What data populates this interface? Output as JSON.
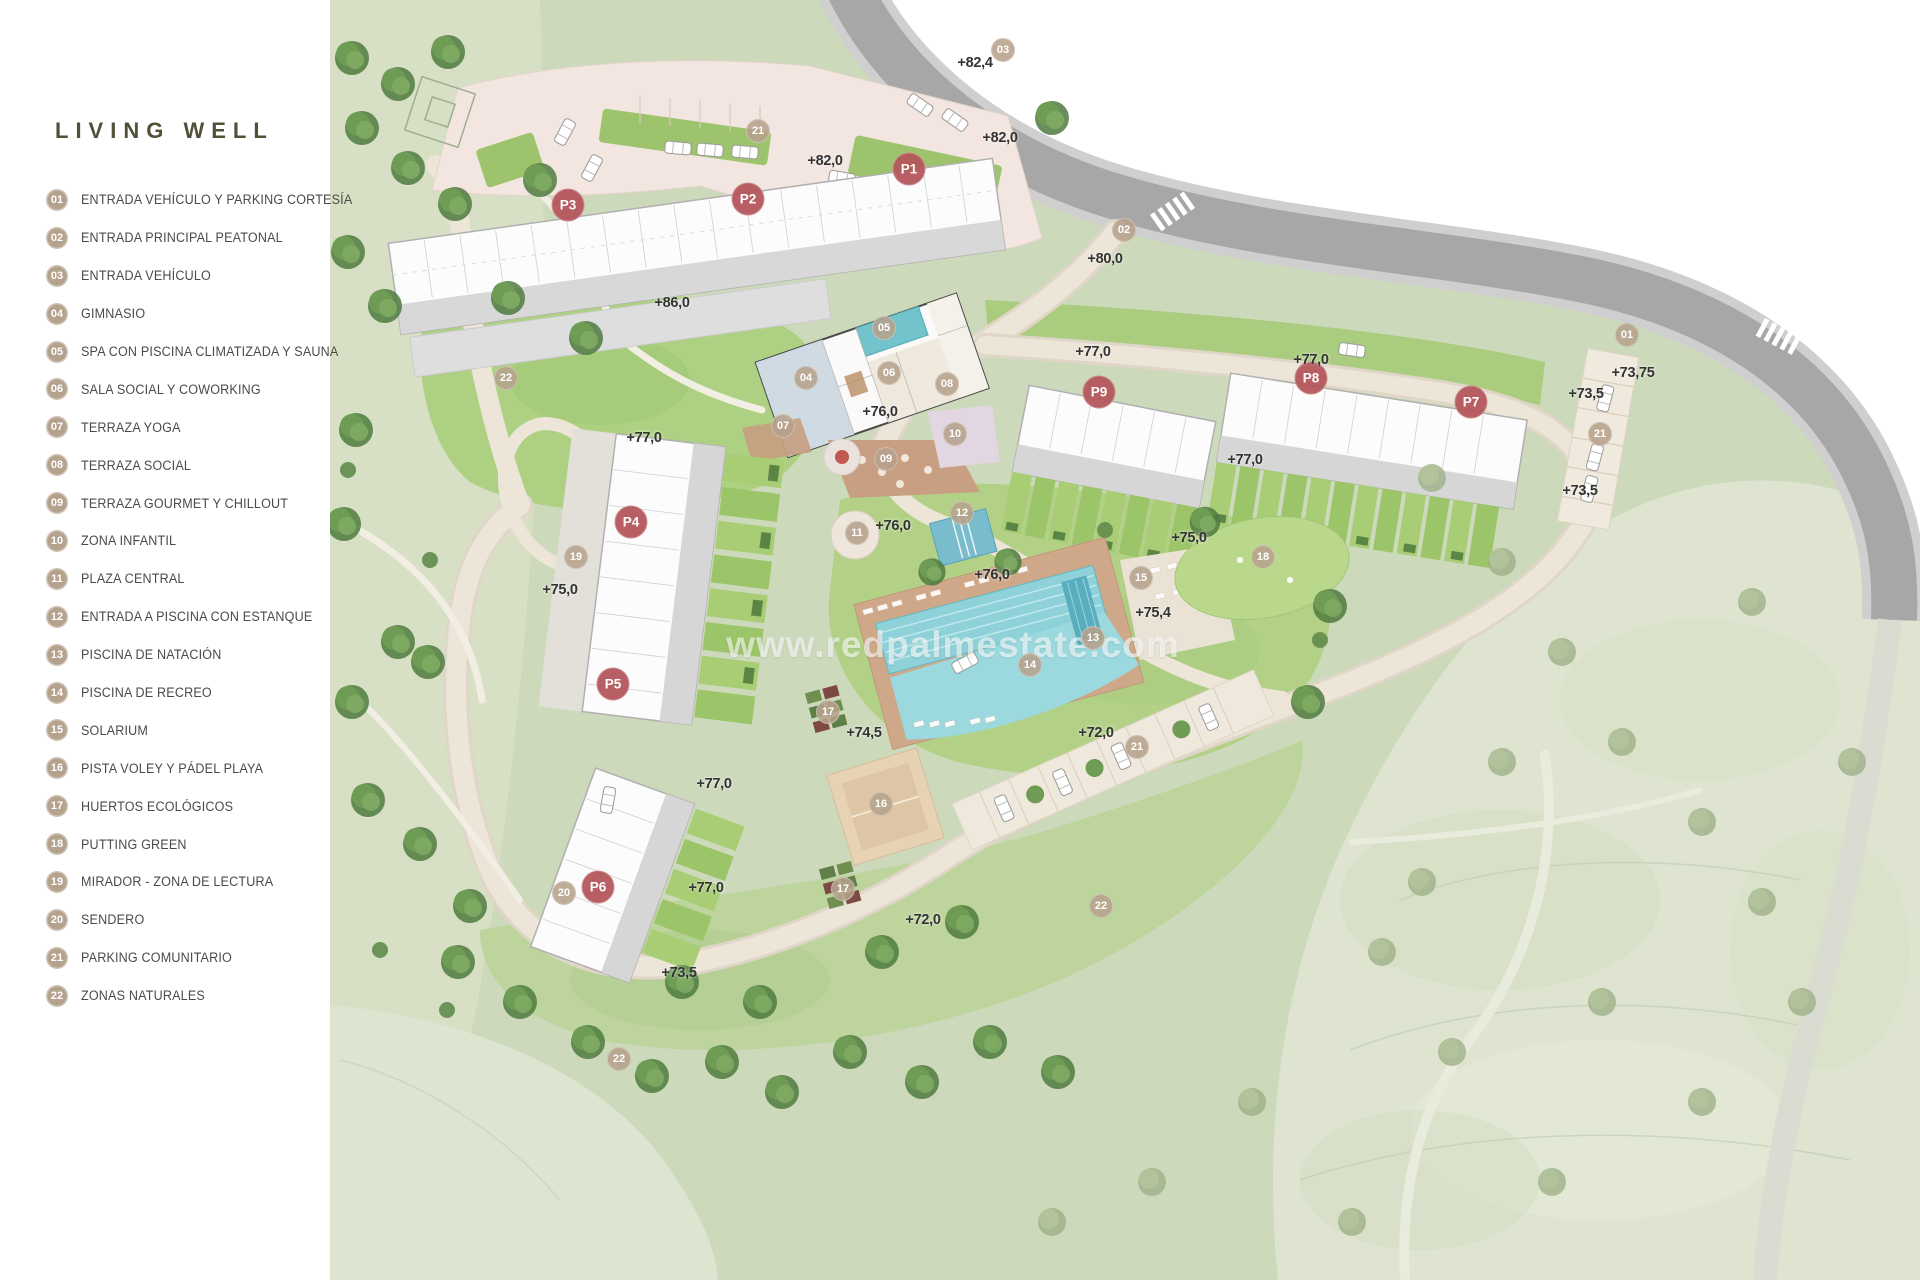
{
  "title": "LIVING WELL",
  "watermark": "www.redpalmestate.com",
  "colors": {
    "title_text": "#53503a",
    "legend_text": "#4a4a4a",
    "badge": "#b5a28d",
    "phase_marker": "#b4575c",
    "point_marker": "#b6a28c",
    "elevation_text": "#333333"
  },
  "legend": [
    {
      "num": "01",
      "label": "ENTRADA VEHÍCULO Y PARKING CORTESÍA"
    },
    {
      "num": "02",
      "label": "ENTRADA PRINCIPAL PEATONAL"
    },
    {
      "num": "03",
      "label": "ENTRADA VEHÍCULO"
    },
    {
      "num": "04",
      "label": "GIMNASIO"
    },
    {
      "num": "05",
      "label": "SPA CON PISCINA CLIMATIZADA Y SAUNA"
    },
    {
      "num": "06",
      "label": "SALA SOCIAL Y COWORKING"
    },
    {
      "num": "07",
      "label": "TERRAZA YOGA"
    },
    {
      "num": "08",
      "label": "TERRAZA SOCIAL"
    },
    {
      "num": "09",
      "label": "TERRAZA GOURMET Y CHILLOUT"
    },
    {
      "num": "10",
      "label": "ZONA INFANTIL"
    },
    {
      "num": "11",
      "label": "PLAZA CENTRAL"
    },
    {
      "num": "12",
      "label": "ENTRADA A PISCINA CON ESTANQUE"
    },
    {
      "num": "13",
      "label": "PISCINA DE NATACIÓN"
    },
    {
      "num": "14",
      "label": "PISCINA DE RECREO"
    },
    {
      "num": "15",
      "label": "SOLARIUM"
    },
    {
      "num": "16",
      "label": "PISTA VOLEY Y PÁDEL PLAYA"
    },
    {
      "num": "17",
      "label": "HUERTOS ECOLÓGICOS"
    },
    {
      "num": "18",
      "label": "PUTTING GREEN"
    },
    {
      "num": "19",
      "label": "MIRADOR - ZONA DE LECTURA"
    },
    {
      "num": "20",
      "label": "SENDERO"
    },
    {
      "num": "21",
      "label": "PARKING COMUNITARIO"
    },
    {
      "num": "22",
      "label": "ZONAS NATURALES"
    }
  ],
  "map": {
    "phase_markers": [
      {
        "id": "P1",
        "x": 909,
        "y": 169
      },
      {
        "id": "P2",
        "x": 748,
        "y": 199
      },
      {
        "id": "P3",
        "x": 568,
        "y": 205
      },
      {
        "id": "P4",
        "x": 631,
        "y": 522
      },
      {
        "id": "P5",
        "x": 613,
        "y": 684
      },
      {
        "id": "P6",
        "x": 598,
        "y": 887
      },
      {
        "id": "P7",
        "x": 1471,
        "y": 402
      },
      {
        "id": "P8",
        "x": 1311,
        "y": 378
      },
      {
        "id": "P9",
        "x": 1099,
        "y": 392
      }
    ],
    "point_markers": [
      {
        "num": "01",
        "x": 1627,
        "y": 335
      },
      {
        "num": "02",
        "x": 1124,
        "y": 230
      },
      {
        "num": "03",
        "x": 1003,
        "y": 50
      },
      {
        "num": "04",
        "x": 806,
        "y": 378
      },
      {
        "num": "05",
        "x": 884,
        "y": 328
      },
      {
        "num": "06",
        "x": 889,
        "y": 373
      },
      {
        "num": "07",
        "x": 783,
        "y": 426
      },
      {
        "num": "08",
        "x": 947,
        "y": 384
      },
      {
        "num": "09",
        "x": 886,
        "y": 459
      },
      {
        "num": "10",
        "x": 955,
        "y": 434
      },
      {
        "num": "11",
        "x": 857,
        "y": 533
      },
      {
        "num": "12",
        "x": 962,
        "y": 513
      },
      {
        "num": "13",
        "x": 1093,
        "y": 638
      },
      {
        "num": "14",
        "x": 1030,
        "y": 665
      },
      {
        "num": "15",
        "x": 1141,
        "y": 578
      },
      {
        "num": "16",
        "x": 881,
        "y": 804
      },
      {
        "num": "17",
        "x": 828,
        "y": 712
      },
      {
        "num": "17",
        "x": 843,
        "y": 889
      },
      {
        "num": "18",
        "x": 1263,
        "y": 557
      },
      {
        "num": "19",
        "x": 576,
        "y": 557
      },
      {
        "num": "20",
        "x": 564,
        "y": 893
      },
      {
        "num": "21",
        "x": 758,
        "y": 131
      },
      {
        "num": "21",
        "x": 1600,
        "y": 434
      },
      {
        "num": "21",
        "x": 1137,
        "y": 747
      },
      {
        "num": "22",
        "x": 506,
        "y": 378
      },
      {
        "num": "22",
        "x": 1101,
        "y": 906
      },
      {
        "num": "22",
        "x": 619,
        "y": 1059
      }
    ],
    "elevation_labels": [
      {
        "text": "+82,4",
        "x": 975,
        "y": 63
      },
      {
        "text": "+82,0",
        "x": 1000,
        "y": 138
      },
      {
        "text": "+82,0",
        "x": 825,
        "y": 161
      },
      {
        "text": "+80,0",
        "x": 1105,
        "y": 259
      },
      {
        "text": "+86,0",
        "x": 672,
        "y": 303
      },
      {
        "text": "+77,0",
        "x": 1093,
        "y": 352
      },
      {
        "text": "+77,0",
        "x": 1311,
        "y": 360
      },
      {
        "text": "+73,75",
        "x": 1633,
        "y": 373
      },
      {
        "text": "+73,5",
        "x": 1586,
        "y": 394
      },
      {
        "text": "+76,0",
        "x": 880,
        "y": 412
      },
      {
        "text": "+77,0",
        "x": 644,
        "y": 438
      },
      {
        "text": "+77,0",
        "x": 1245,
        "y": 460
      },
      {
        "text": "+73,5",
        "x": 1580,
        "y": 491
      },
      {
        "text": "+76,0",
        "x": 893,
        "y": 526
      },
      {
        "text": "+75,0",
        "x": 1189,
        "y": 538
      },
      {
        "text": "+76,0",
        "x": 992,
        "y": 575
      },
      {
        "text": "+75,0",
        "x": 560,
        "y": 590
      },
      {
        "text": "+75,4",
        "x": 1153,
        "y": 613
      },
      {
        "text": "+74,5",
        "x": 864,
        "y": 733
      },
      {
        "text": "+72,0",
        "x": 1096,
        "y": 733
      },
      {
        "text": "+77,0",
        "x": 714,
        "y": 784
      },
      {
        "text": "+77,0",
        "x": 706,
        "y": 888
      },
      {
        "text": "+72,0",
        "x": 923,
        "y": 920
      },
      {
        "text": "+73,5",
        "x": 679,
        "y": 973
      }
    ]
  }
}
